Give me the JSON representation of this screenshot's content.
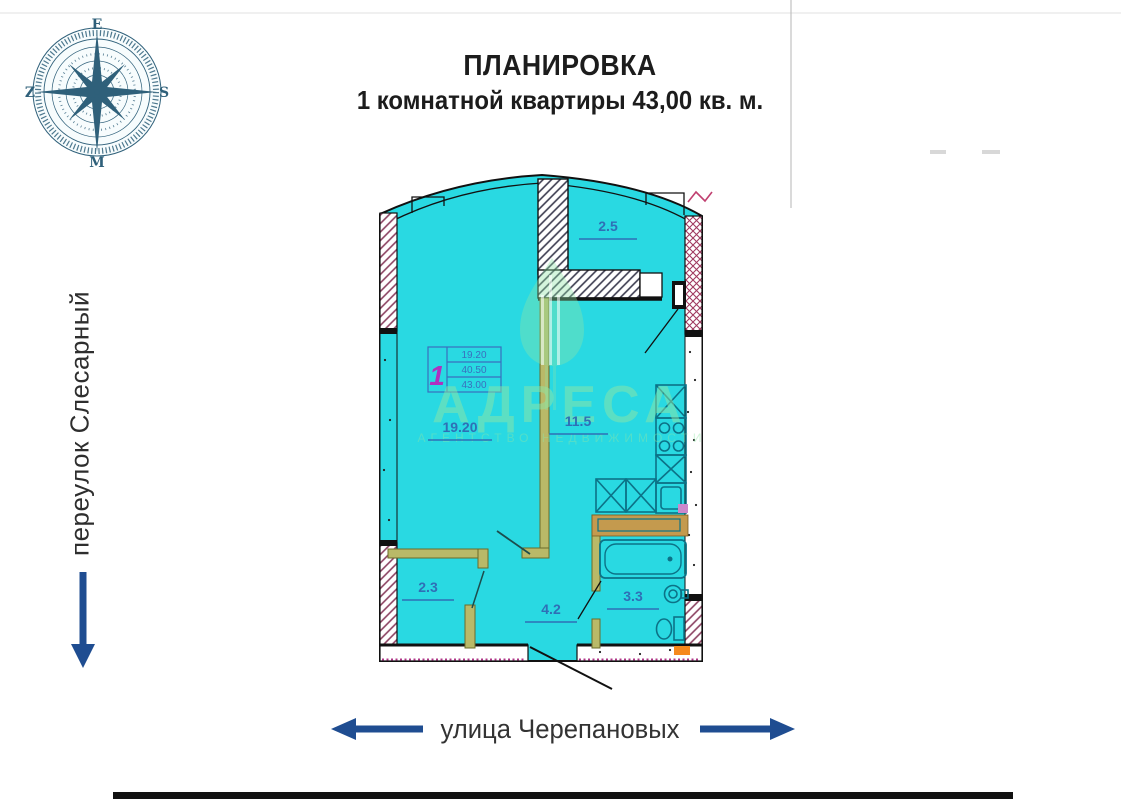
{
  "title": {
    "line1": "ПЛАНИРОВКА",
    "line2": "1 комнатной квартиры 43,00 кв. м."
  },
  "compass": {
    "top": "E",
    "right": "S",
    "bottom": "M",
    "left": "Z"
  },
  "streets": {
    "left_vertical": "переулок Слесарный",
    "bottom": "улица Черепановых"
  },
  "plan": {
    "rooms": {
      "living": {
        "label": "19.20"
      },
      "kitchen": {
        "label": "11.5"
      },
      "balcony": {
        "label": "2.5"
      },
      "wardrobe": {
        "label": "2.3"
      },
      "hallway": {
        "label": "4.2"
      },
      "bathroom": {
        "label": "3.3"
      }
    },
    "stamp": {
      "apartment_number": "1",
      "row1": "19.20",
      "row2": "40.50",
      "row3": "43.00"
    }
  },
  "watermark": {
    "word": "АДРЕСА",
    "subline": "АГЕНТСТВО НЕДВИЖИМОСТИ"
  },
  "colors": {
    "floor_cyan": "#29d9e2",
    "label_blue": "#2f6fb6",
    "partition_olive": "#8f8f3f",
    "fixture_teal": "#0c7287",
    "arrow_blue": "#1f4d91",
    "compass_teal": "#2f607a",
    "watermark_green": "#8fe6a5",
    "stamp_magenta": "#b030c0",
    "hatch_maroon": "#8a4060",
    "accent_orange": "#f5891d",
    "dotted_pink": "#b03a8a"
  }
}
